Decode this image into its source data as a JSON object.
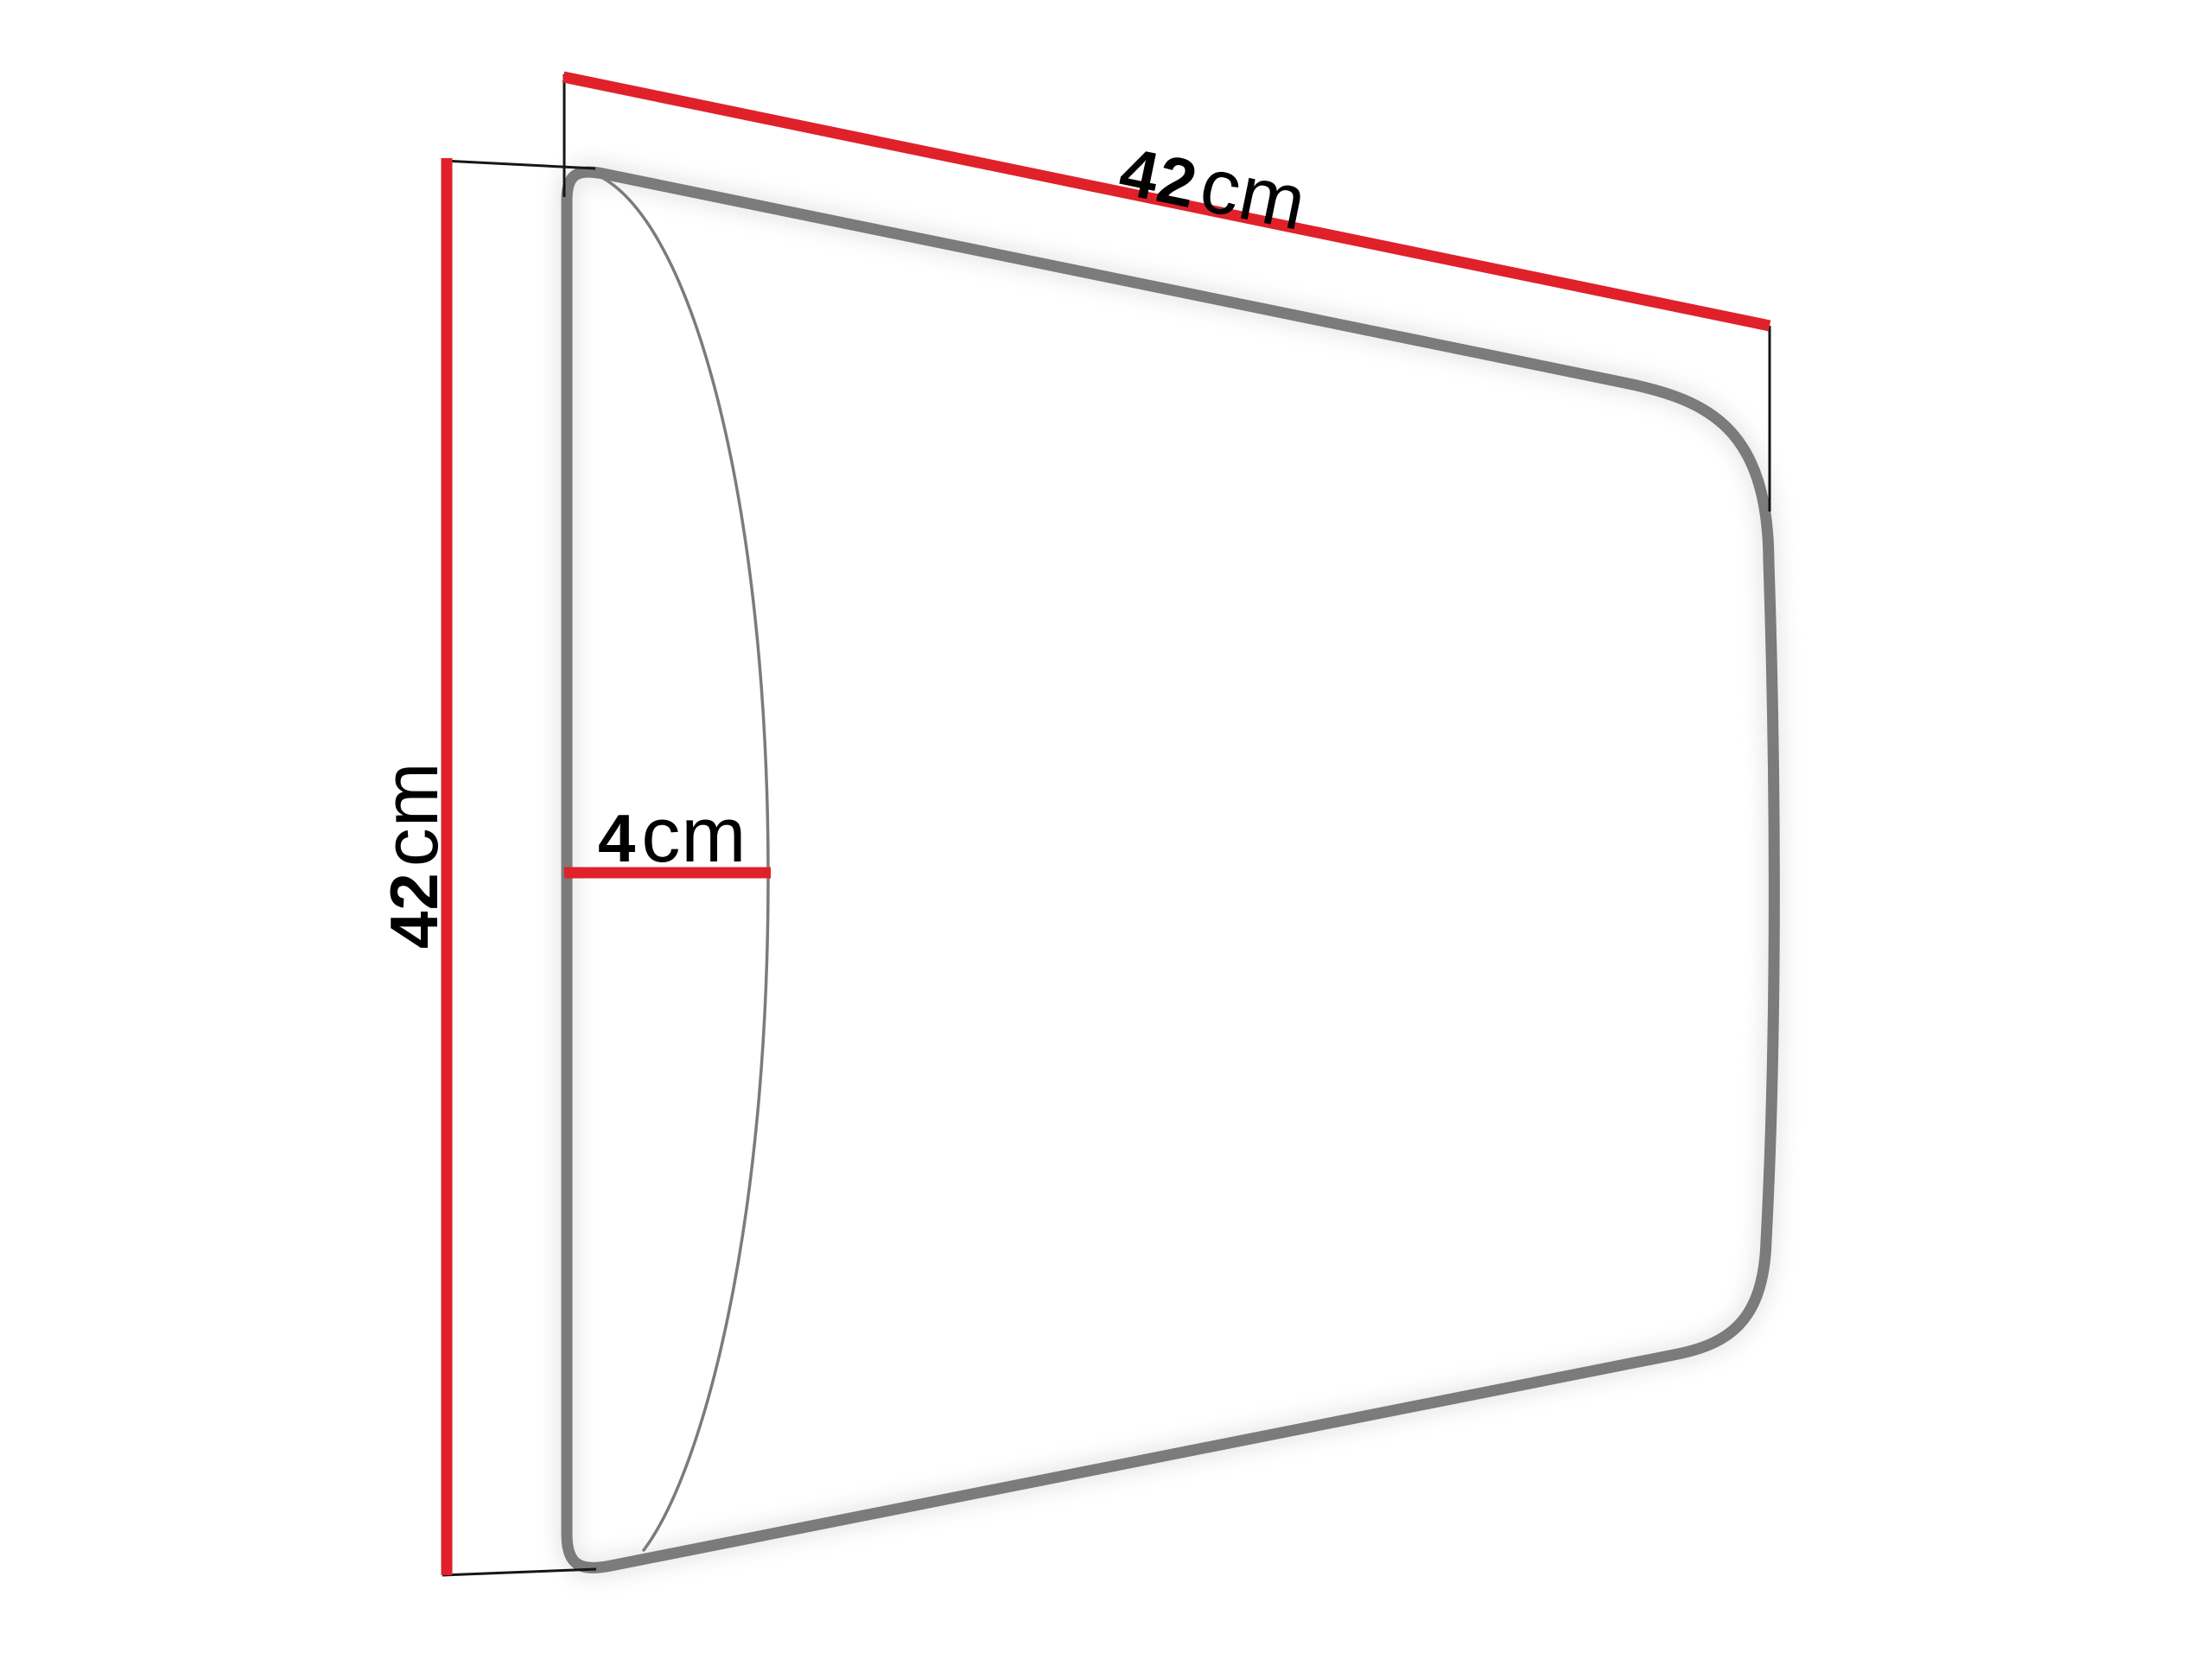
{
  "canvas": {
    "background": "#ffffff"
  },
  "diagram": {
    "kind": "product-dimension-diagram",
    "dimensions": {
      "width": {
        "value": "42",
        "unit": "cm"
      },
      "height": {
        "value": "42",
        "unit": "cm"
      },
      "depth": {
        "value": "4",
        "unit": "cm"
      }
    },
    "colors": {
      "dimension_line": "#e0212a",
      "panel_outline": "#7b7b7b",
      "panel_fill": "#ffffff",
      "extension_line": "#161616",
      "label_text": "#000000",
      "shadow": "#c9c9c9"
    }
  }
}
